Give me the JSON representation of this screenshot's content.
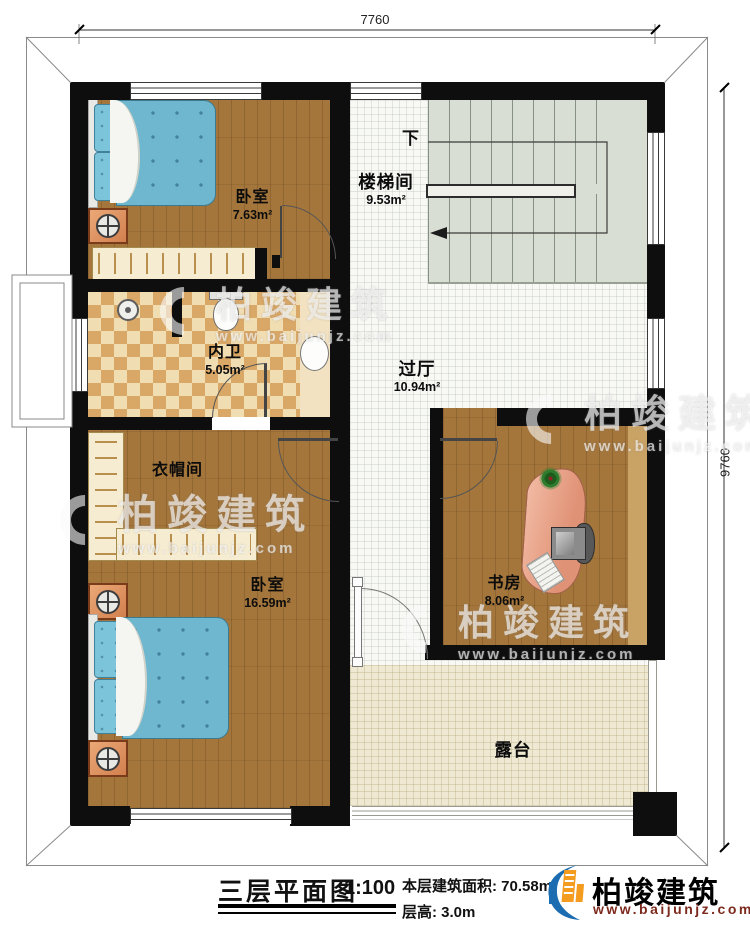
{
  "dimensions": {
    "width_top": "7760",
    "height_right": "9760"
  },
  "rooms": [
    {
      "label": "卧室",
      "area": "7.63m²"
    },
    {
      "label": "楼梯间",
      "area": "9.53m²"
    },
    {
      "label": "内卫",
      "area": "5.05m²"
    },
    {
      "label": "过厅",
      "area": "10.94m²"
    },
    {
      "label": "衣帽间",
      "area": ""
    },
    {
      "label": "卧室",
      "area": "16.59m²"
    },
    {
      "label": "书房",
      "area": "8.06m²"
    },
    {
      "label": "露台",
      "area": ""
    }
  ],
  "stairs": {
    "down_label": "下"
  },
  "title_block": {
    "title": "三层平面图",
    "scale": "1:100",
    "area_line": "本层建筑面积: 70.58m²",
    "floor_height_line": "层高: 3.0m",
    "brand": "柏竣建筑",
    "website": "www.baijunjz.com"
  },
  "watermark": {
    "brand": "柏竣建筑",
    "website": "www.baijunjz.com"
  },
  "colors": {
    "wall": "#0e0e0e",
    "wood_floor": "#a4763c",
    "bed": "#6fb7cf",
    "stair_floor": "#d8ded3",
    "bath_tile": "#d9a766",
    "terrace_floor": "#efe9d3",
    "brand_blue": "#1b6cb0",
    "brand_orange": "#f39c1f",
    "website_red": "#7d2a1e"
  }
}
